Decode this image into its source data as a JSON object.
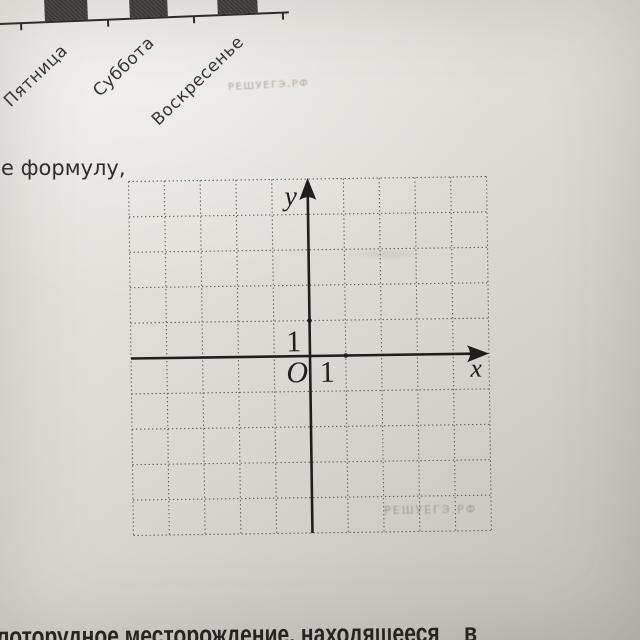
{
  "top_chart": {
    "type": "bar",
    "day_labels": [
      "Пятница",
      "Суббота",
      "Воскресенье"
    ]
  },
  "watermarks": {
    "top": "РЕШУЕГЭ.РФ",
    "grid": "РЕШУЕГЭ.РФ"
  },
  "fragments": {
    "left": "е формулу,",
    "bottom_main": "лоторудное месторождение, находящееся",
    "bottom_tail": "в"
  },
  "grid": {
    "columns": 10,
    "rows": 10,
    "origin_label": "O",
    "x_axis_label": "x",
    "y_axis_label": "y",
    "x_unit_label": "1",
    "y_unit_label": "1"
  },
  "colors": {
    "paper_light": "#edebe6",
    "paper_dark": "#bfbcb7",
    "ink": "#23211e",
    "grid_line": "#57544e",
    "bar_fill": "#3b3936",
    "watermark": "#8a8175"
  }
}
